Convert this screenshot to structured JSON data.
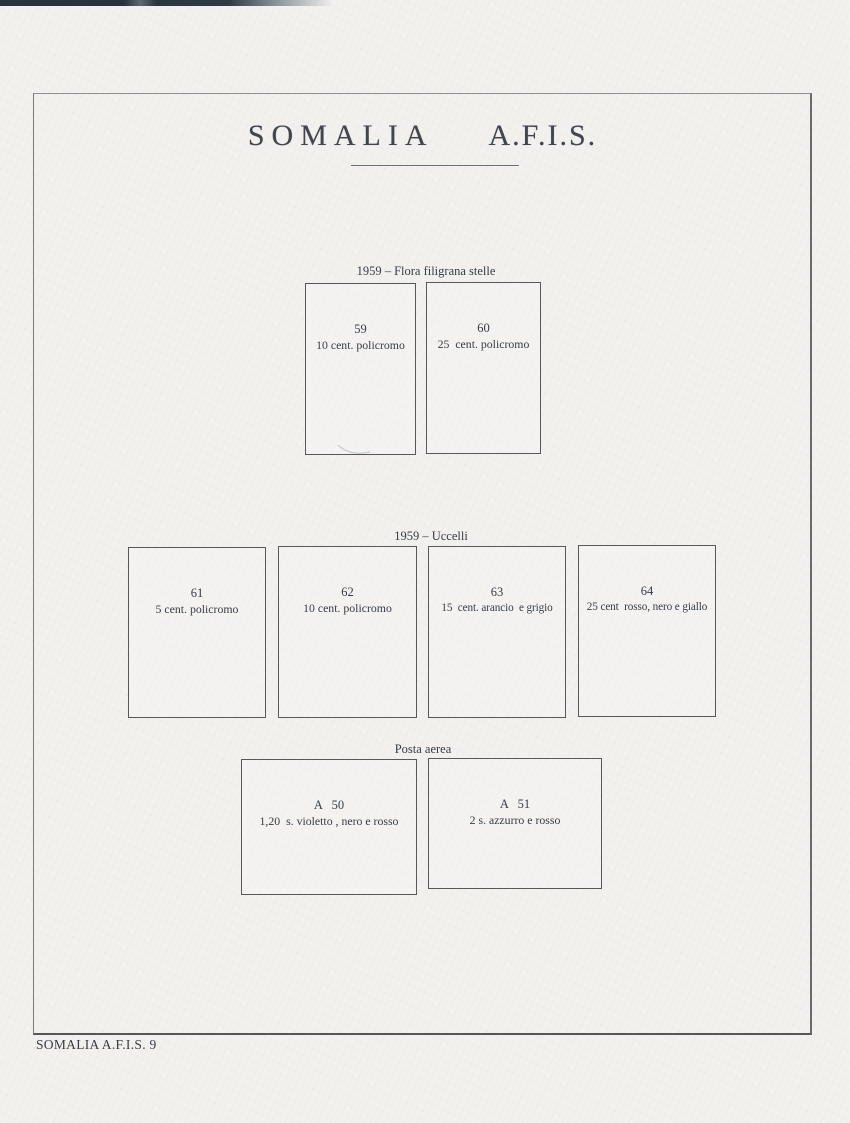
{
  "page": {
    "title_left": "SOMALIA",
    "title_right": "A.F.I.S.",
    "footer": "SOMALIA A.F.I.S. 9"
  },
  "sections": [
    {
      "header": "1959 – Flora filigrana stelle",
      "stamps": [
        {
          "number": "59",
          "caption": "10 cent. policromo"
        },
        {
          "number": "60",
          "caption": "25  cent. policromo"
        }
      ]
    },
    {
      "header": "1959 – Uccelli",
      "stamps": [
        {
          "number": "61",
          "caption": "5 cent. policromo"
        },
        {
          "number": "62",
          "caption": "10 cent. policromo"
        },
        {
          "number": "63",
          "caption": "15  cent. arancio  e grigio"
        },
        {
          "number": "64",
          "caption": "25 cent  rosso, nero e giallo"
        }
      ]
    },
    {
      "header": "Posta aerea",
      "stamps": [
        {
          "number": "A   50",
          "caption": "1,20  s. violetto , nero e rosso"
        },
        {
          "number": "A   51",
          "caption": "2 s. azzurro e rosso"
        }
      ]
    }
  ],
  "colors": {
    "paper": "#f3f1ee",
    "ink": "#363c46",
    "box_line": "#585858",
    "frame_line": "#7a7a7a",
    "scan_edge": "#2c3a42"
  }
}
